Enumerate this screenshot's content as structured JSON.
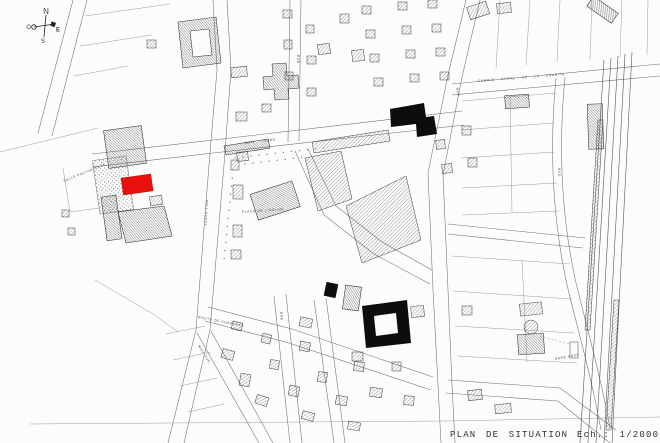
{
  "document": {
    "type_label": "PLAN DE SITUATION",
    "scale_label": "Ech.: 1/2000"
  },
  "compass": {
    "north": "N",
    "south": "S",
    "east": "E",
    "west": "O"
  },
  "colors": {
    "paper": "#fcfcfa",
    "ink": "#3f3f3f",
    "highlight_red": "#e8100c",
    "building_black": "#0d0d0d"
  },
  "map_labels": {
    "salle_polyvalente": "SALLE POLYVALENTE",
    "mail_nord": "MAIL NORD",
    "mail_ouest": "MAIL OUEST",
    "mail_sud": "MAIL SUD",
    "place_eglise": "PLACE DE L'EGLISE",
    "route_de_chartres": "ROUTE DE CHARTRES",
    "chemin_rural": "CHEMIN RURAL DE LA CHARITE",
    "gare_sncf": "GARE SNCF",
    "rue": "RUE"
  }
}
